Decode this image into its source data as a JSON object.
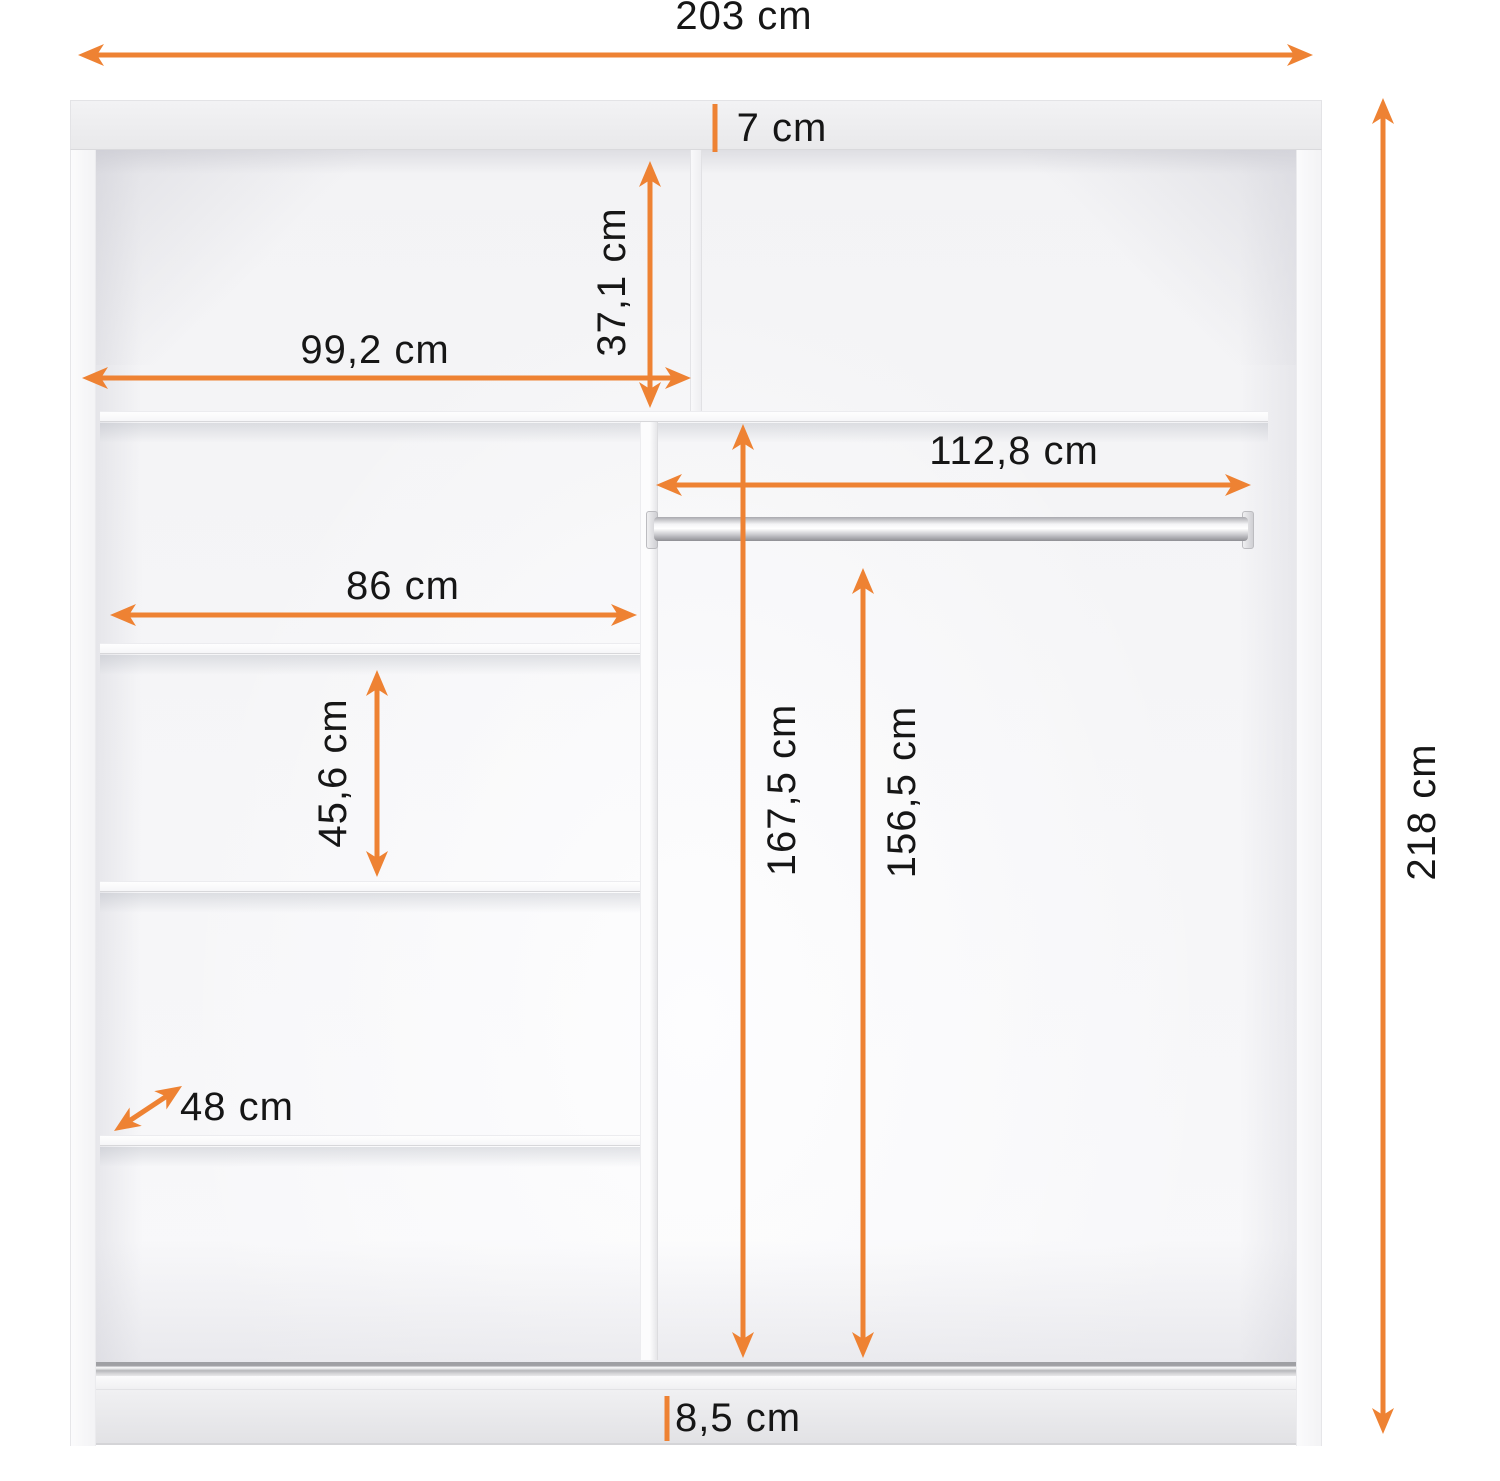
{
  "accent_color": "#ee8233",
  "text_color": "#161616",
  "unit": "cm",
  "labels": {
    "total_width": "203 cm",
    "top_panel": "7 cm",
    "upper_compartment_height": "37,1 cm",
    "left_compartment_width": "99,2 cm",
    "right_compartment_width": "112,8 cm",
    "shelf_width": "86 cm",
    "shelf_spacing_height": "45,6 cm",
    "depth": "48 cm",
    "left_interior_height": "167,5 cm",
    "rod_height": "156,5 cm",
    "plinth_height": "8,5 cm",
    "total_height": "218 cm"
  }
}
